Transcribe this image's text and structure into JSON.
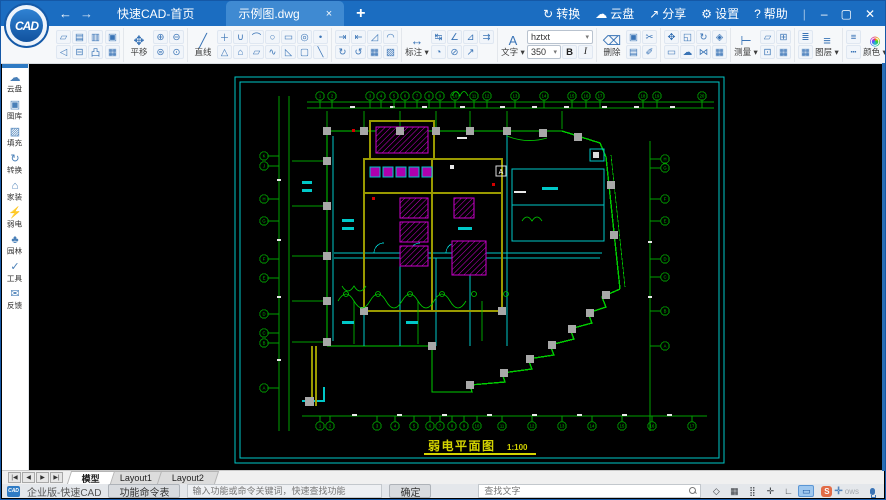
{
  "titlebar": {
    "logo_text": "CAD",
    "back_glyph": "←",
    "forward_glyph": "→",
    "tabs": {
      "home": "快速CAD-首页",
      "doc": "示例图.dwg",
      "close_glyph": "×",
      "new_glyph": "+"
    },
    "menu": [
      {
        "name": "convert",
        "glyph": "↻",
        "label": "转换"
      },
      {
        "name": "cloud",
        "glyph": "☁",
        "label": "云盘"
      },
      {
        "name": "share",
        "glyph": "↗",
        "label": "分享"
      },
      {
        "name": "settings",
        "glyph": "⚙",
        "label": "设置"
      },
      {
        "name": "help",
        "glyph": "?",
        "label": "帮助"
      }
    ],
    "window_buttons": [
      {
        "name": "minimize",
        "glyph": "–"
      },
      {
        "name": "maximize",
        "glyph": "▢"
      },
      {
        "name": "close",
        "glyph": "✕"
      }
    ]
  },
  "toolbar": {
    "font_value": "hztxt",
    "size_value": "350",
    "bold_label": "B",
    "italic_label": "I",
    "swatches": {
      "row1": [
        {
          "name": "white",
          "hex": "#ffffff"
        },
        {
          "name": "red",
          "hex": "#d93025"
        },
        {
          "name": "yellow",
          "hex": "#e8e135"
        },
        {
          "name": "light-green",
          "hex": "#8bc34a"
        }
      ],
      "row2": [
        {
          "name": "black",
          "hex": "#111111"
        },
        {
          "name": "cyan",
          "hex": "#26b7d0"
        },
        {
          "name": "green",
          "hex": "#1ea45a"
        },
        {
          "name": "purple",
          "hex": "#8e44c9"
        }
      ]
    },
    "groups": [
      {
        "name": "file",
        "cols": [
          {
            "type": "rows",
            "rows": [
              [
                {
                  "n": "open-file",
                  "g": "▱"
                },
                {
                  "n": "save-file",
                  "g": "▤"
                },
                {
                  "n": "save-as",
                  "g": "▥"
                }
              ],
              [
                {
                  "n": "undo",
                  "g": "◁"
                },
                {
                  "n": "print",
                  "g": "⊟"
                },
                {
                  "n": "export-pdf",
                  "g": "凸"
                }
              ]
            ]
          },
          {
            "type": "rows",
            "rows": [
              [
                {
                  "n": "export-image",
                  "g": "▣"
                }
              ],
              [
                {
                  "n": "insert-image",
                  "g": "▦"
                }
              ]
            ]
          }
        ]
      },
      {
        "name": "view",
        "cols": [
          {
            "type": "big",
            "n": "pan",
            "g": "✥",
            "label": "平移"
          },
          {
            "type": "rows",
            "rows": [
              [
                {
                  "n": "zoom-in",
                  "g": "⊕"
                },
                {
                  "n": "zoom-out",
                  "g": "⊖"
                }
              ],
              [
                {
                  "n": "zoom-extents",
                  "g": "⊜"
                },
                {
                  "n": "zoom-window",
                  "g": "⊙"
                }
              ]
            ]
          }
        ]
      },
      {
        "name": "draw",
        "cols": [
          {
            "type": "big",
            "n": "line",
            "g": "╱",
            "label": "直线"
          },
          {
            "type": "rows",
            "rows": [
              [
                {
                  "n": "xline",
                  "g": "＋"
                },
                {
                  "n": "polyline",
                  "g": "∪"
                },
                {
                  "n": "arc",
                  "g": "⌒"
                },
                {
                  "n": "circle",
                  "g": "○"
                },
                {
                  "n": "rectangle",
                  "g": "▭"
                },
                {
                  "n": "ellipse",
                  "g": "◎"
                },
                {
                  "n": "point",
                  "g": "•"
                }
              ],
              [
                {
                  "n": "triangle",
                  "g": "△"
                },
                {
                  "n": "polygon",
                  "g": "⌂"
                },
                {
                  "n": "parallelogram",
                  "g": "▱"
                },
                {
                  "n": "spline",
                  "g": "∿"
                },
                {
                  "n": "wedge",
                  "g": "◺"
                },
                {
                  "n": "round-rect",
                  "g": "▢"
                },
                {
                  "n": "ray",
                  "g": "╲"
                }
              ]
            ]
          }
        ]
      },
      {
        "name": "modify",
        "cols": [
          {
            "type": "rows",
            "rows": [
              [
                {
                  "n": "trim",
                  "g": "⇥"
                },
                {
                  "n": "extend",
                  "g": "⇤"
                },
                {
                  "n": "fillet",
                  "g": "◿"
                },
                {
                  "n": "chamfer",
                  "g": "◠"
                }
              ],
              [
                {
                  "n": "rotate-cw",
                  "g": "↻"
                },
                {
                  "n": "rotate-ccw",
                  "g": "↺"
                },
                {
                  "n": "hatch",
                  "g": "▦"
                },
                {
                  "n": "block",
                  "g": "▧"
                }
              ]
            ]
          }
        ]
      },
      {
        "name": "dimension",
        "cols": [
          {
            "type": "big",
            "n": "dimension",
            "g": "↔",
            "label": "标注",
            "caret": true
          },
          {
            "type": "rows",
            "rows": [
              [
                {
                  "n": "dim-linear",
                  "g": "↹"
                },
                {
                  "n": "dim-angular",
                  "g": "∠"
                },
                {
                  "n": "dim-aligned",
                  "g": "⊿"
                },
                {
                  "n": "dim-continue",
                  "g": "⇉"
                }
              ],
              [
                {
                  "n": "dim-radius",
                  "g": "◔"
                },
                {
                  "n": "dim-diameter",
                  "g": "⊘"
                },
                {
                  "n": "dim-leader",
                  "g": "↗"
                }
              ]
            ]
          }
        ]
      },
      {
        "name": "text",
        "cols": [
          {
            "type": "big",
            "n": "text",
            "g": "A",
            "label": "文字",
            "caret": true
          },
          {
            "type": "font"
          }
        ]
      },
      {
        "name": "edit",
        "cols": [
          {
            "type": "big",
            "n": "erase",
            "g": "⌫",
            "label": "删除"
          },
          {
            "type": "rows",
            "rows": [
              [
                {
                  "n": "copy",
                  "g": "▣"
                },
                {
                  "n": "cut",
                  "g": "✂"
                }
              ],
              [
                {
                  "n": "paste",
                  "g": "▤"
                },
                {
                  "n": "format-brush",
                  "g": "✐"
                }
              ]
            ]
          }
        ]
      },
      {
        "name": "transform",
        "cols": [
          {
            "type": "rows",
            "rows": [
              [
                {
                  "n": "move",
                  "g": "✥"
                },
                {
                  "n": "scale",
                  "g": "◱"
                },
                {
                  "n": "rotate",
                  "g": "↻"
                },
                {
                  "n": "3d-orbit",
                  "g": "◈"
                }
              ],
              [
                {
                  "n": "clip",
                  "g": "▭"
                },
                {
                  "n": "cloud-upload",
                  "g": "☁"
                },
                {
                  "n": "mirror",
                  "g": "⋈"
                },
                {
                  "n": "array",
                  "g": "▦"
                }
              ]
            ]
          }
        ]
      },
      {
        "name": "measure",
        "cols": [
          {
            "type": "big",
            "n": "measure",
            "g": "⊢",
            "label": "测量",
            "caret": true
          },
          {
            "type": "rows",
            "rows": [
              [
                {
                  "n": "measure-area",
                  "g": "▱"
                },
                {
                  "n": "count",
                  "g": "⊞"
                }
              ],
              [
                {
                  "n": "coordinate",
                  "g": "⊡"
                },
                {
                  "n": "table",
                  "g": "▦"
                }
              ]
            ]
          }
        ]
      },
      {
        "name": "layer",
        "cols": [
          {
            "type": "rows",
            "rows": [
              [
                {
                  "n": "layer-stack",
                  "g": "≣"
                }
              ],
              [
                {
                  "n": "layer-grid",
                  "g": "▦"
                }
              ]
            ]
          },
          {
            "type": "big",
            "n": "layers",
            "g": "≡",
            "label": "图层",
            "caret": true
          }
        ]
      },
      {
        "name": "color",
        "cols": [
          {
            "type": "rows",
            "rows": [
              [
                {
                  "n": "lineweight",
                  "g": "≡"
                }
              ],
              [
                {
                  "n": "linetype",
                  "g": "┅"
                }
              ]
            ]
          },
          {
            "type": "big",
            "n": "palette",
            "g": "◉",
            "label": "颜色",
            "caret": true,
            "rainbow": true
          },
          {
            "type": "rows",
            "rows": [
              [
                {
                  "n": "match-properties",
                  "g": "✐"
                }
              ],
              [
                {
                  "n": "color-cloud",
                  "g": "☁"
                }
              ]
            ]
          },
          {
            "type": "swatches"
          }
        ]
      }
    ]
  },
  "sidebar": {
    "items": [
      {
        "name": "cloud-drive",
        "glyph": "☁",
        "label": "云盘"
      },
      {
        "name": "gallery",
        "glyph": "▣",
        "label": "图库"
      },
      {
        "name": "hatch-fill",
        "glyph": "▨",
        "label": "填充"
      },
      {
        "name": "convert",
        "glyph": "↻",
        "label": "转换"
      },
      {
        "name": "home-design",
        "glyph": "⌂",
        "label": "家装"
      },
      {
        "name": "low-voltage",
        "glyph": "⚡",
        "label": "弱电"
      },
      {
        "name": "landscape",
        "glyph": "♣",
        "label": "园林"
      },
      {
        "name": "tools",
        "glyph": "✓",
        "label": "工具"
      },
      {
        "name": "feedback",
        "glyph": "✉",
        "label": "反馈"
      }
    ]
  },
  "drawing": {
    "title": "弱电平面图",
    "scale": "1:100",
    "marker": "A",
    "top_axis": [
      "1",
      "2",
      "3",
      "4",
      "5",
      "6",
      "7",
      "8",
      "9",
      "10",
      "11",
      "12",
      "13",
      "14",
      "15",
      "16",
      "17",
      "18",
      "19",
      "20"
    ],
    "bottom_axis": [
      "1",
      "2",
      "3",
      "4",
      "5",
      "6",
      "7",
      "8",
      "9",
      "10",
      "11",
      "12",
      "13",
      "14",
      "15",
      "16",
      "17"
    ],
    "left_axis": [
      "K",
      "J",
      "H",
      "G",
      "F",
      "E",
      "D",
      "C",
      "B",
      "A"
    ],
    "right_axis": [
      "H",
      "G",
      "F",
      "E",
      "D",
      "C",
      "B",
      "A"
    ]
  },
  "sheetbar": {
    "nav": [
      {
        "n": "first-sheet",
        "g": "|◀"
      },
      {
        "n": "prev-sheet",
        "g": "◀"
      },
      {
        "n": "next-sheet",
        "g": "▶"
      },
      {
        "n": "last-sheet",
        "g": "▶|"
      }
    ],
    "tabs": [
      {
        "name": "model",
        "label": "模型",
        "active": true
      },
      {
        "name": "layout1",
        "label": "Layout1",
        "active": false
      },
      {
        "name": "layout2",
        "label": "Layout2",
        "active": false
      }
    ]
  },
  "statusbar": {
    "brand": "企业版-快速CAD",
    "command_button": "功能命令表",
    "command_placeholder": "输入功能或命令关键词，快速查找功能",
    "ok_button": "确定",
    "find_placeholder": "查找文字",
    "icons": [
      {
        "n": "object-snap-3d",
        "g": "◇",
        "active": false
      },
      {
        "n": "grid-display",
        "g": "▦",
        "active": false
      },
      {
        "n": "dot-grid",
        "g": "⣿",
        "active": false
      },
      {
        "n": "snap-mode",
        "g": "✛",
        "active": false
      },
      {
        "n": "ortho-mode",
        "g": "∟",
        "active": false
      },
      {
        "n": "screen-display",
        "g": "▭",
        "active": true
      }
    ],
    "watermark": {
      "badge": "S",
      "cross": "✛",
      "text": "ows"
    }
  },
  "colors": {
    "titlebar_blue": "#1b6dc1",
    "canvas_black": "#000000",
    "cad_cyan": "#00c8c8",
    "cad_green": "#00cc00",
    "cad_magenta": "#cc00cc",
    "cad_yellow": "#d4d400",
    "cad_olive": "#9a9a00"
  }
}
